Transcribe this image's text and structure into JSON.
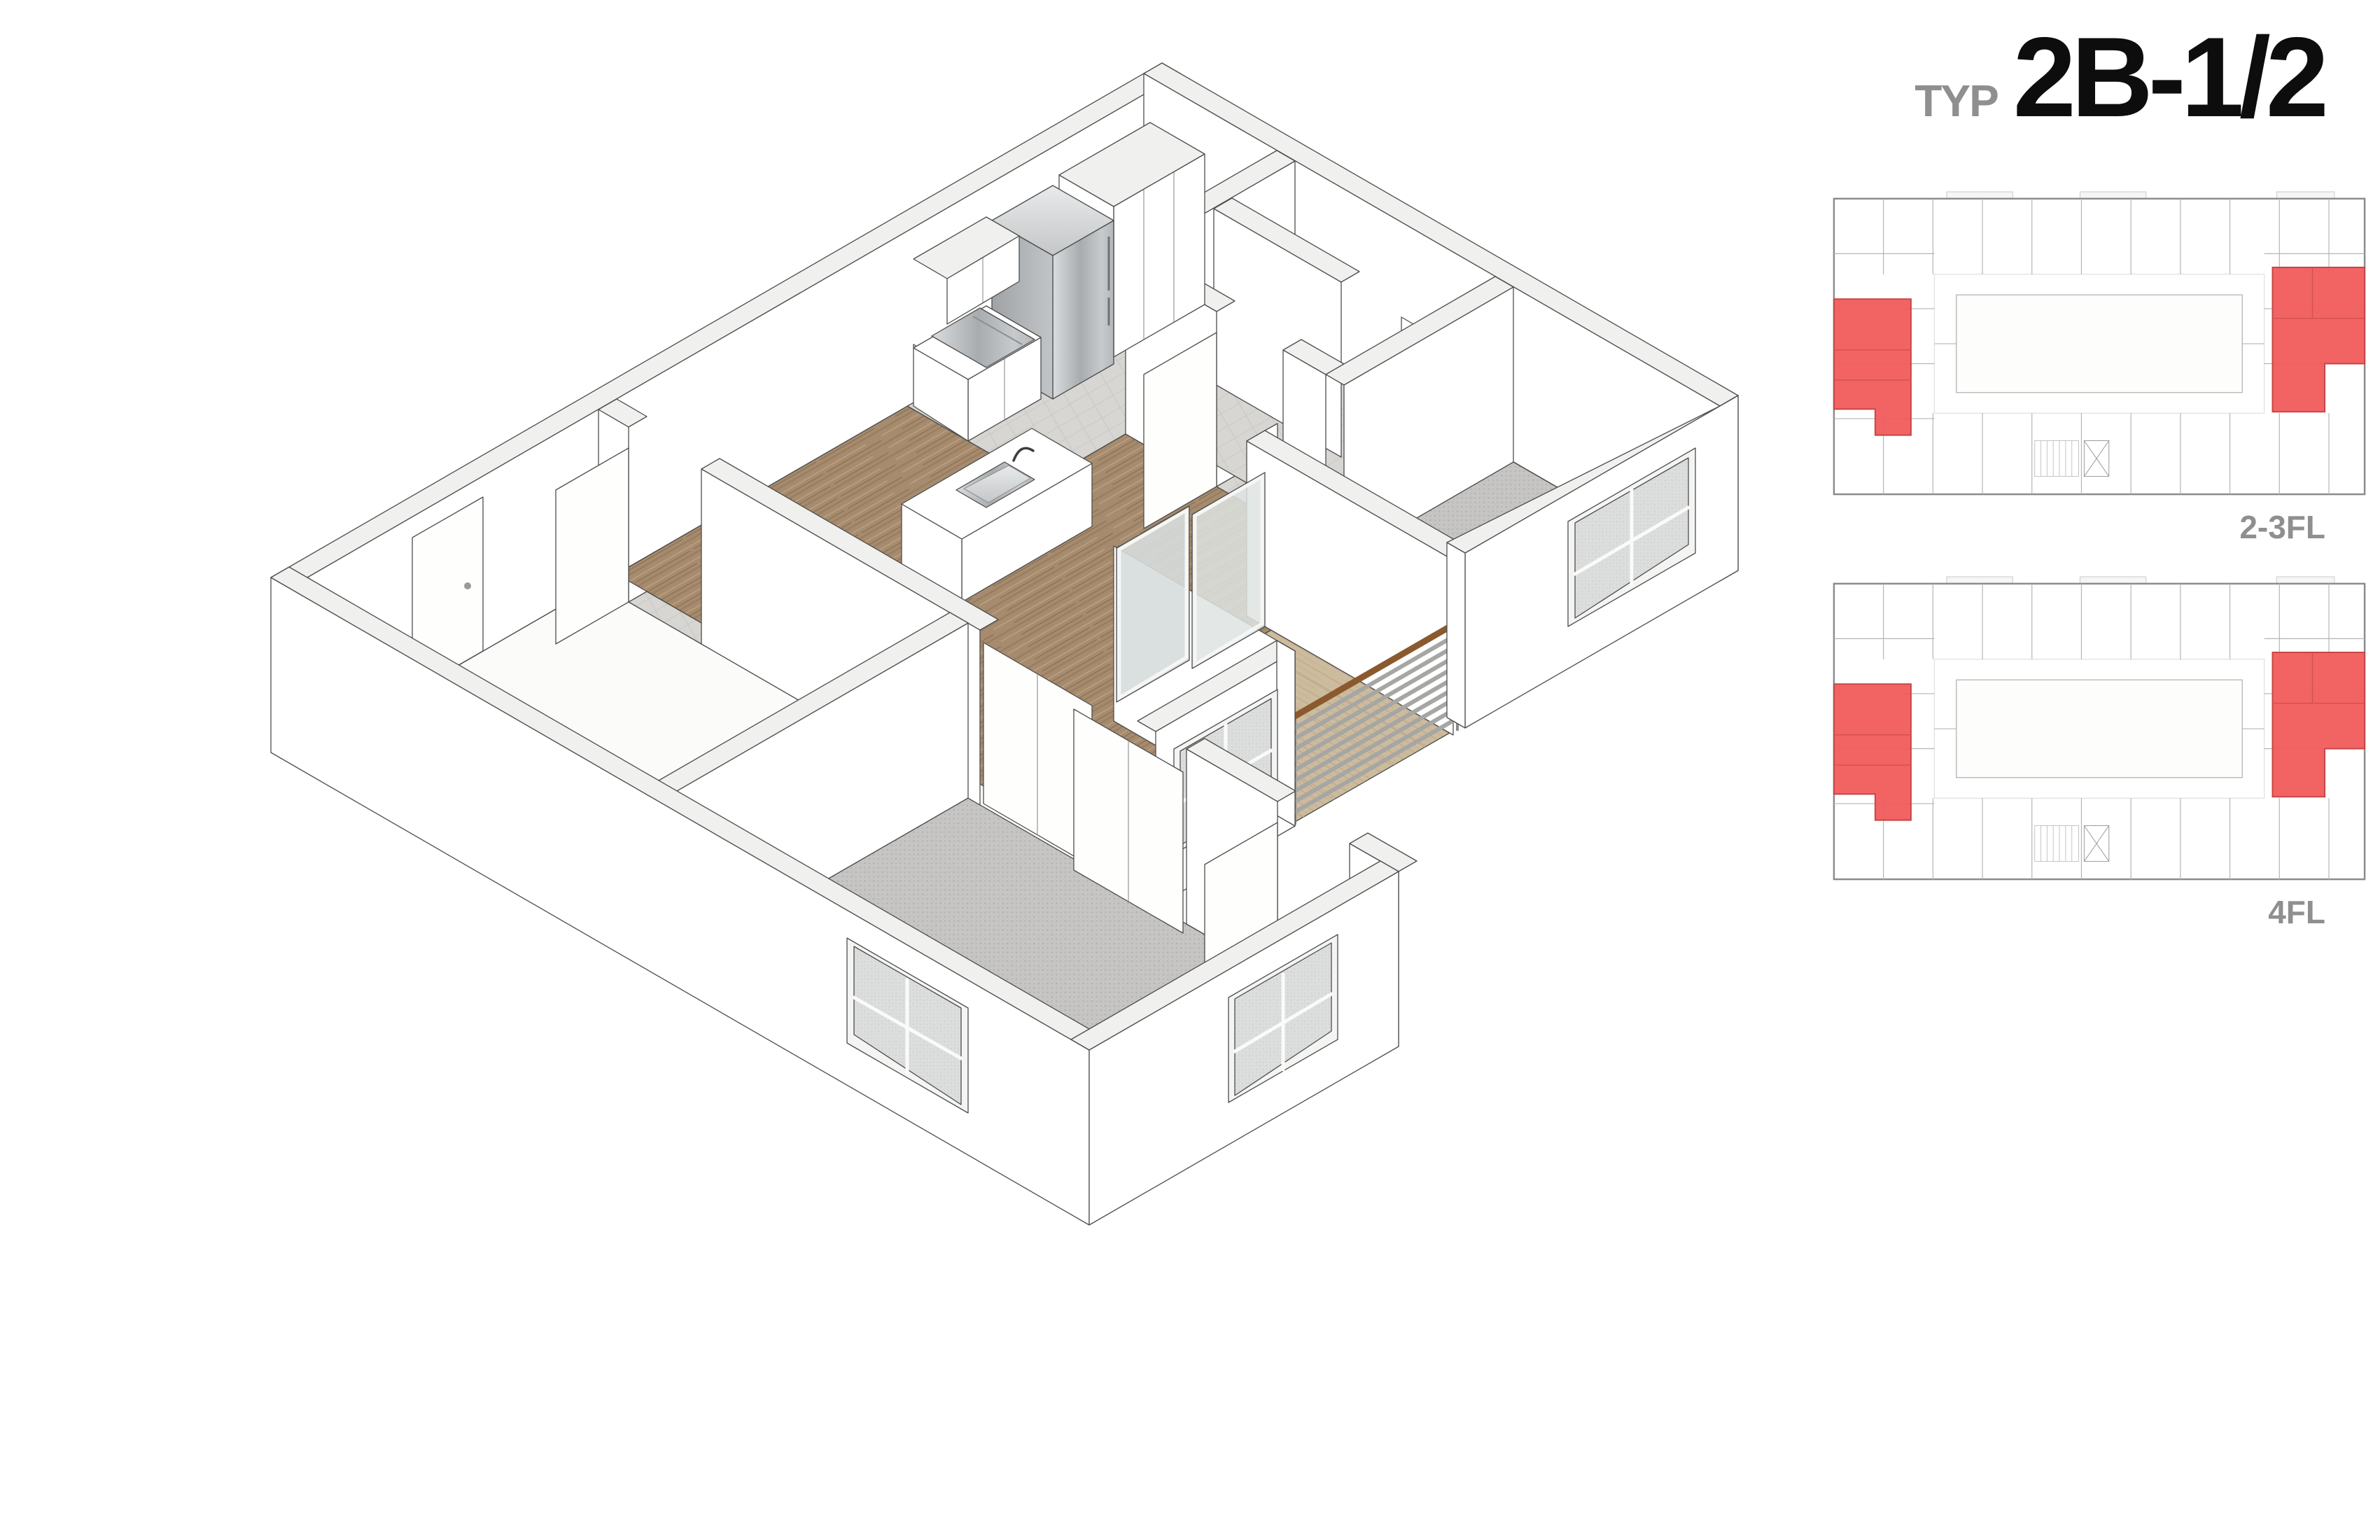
{
  "title": {
    "prefix": "TYP",
    "name": "2B-1/2"
  },
  "key_plans": [
    {
      "label": "2-3FL",
      "highlighted_units": [
        "west-wing-middle",
        "east-wing-middle"
      ]
    },
    {
      "label": "4FL",
      "highlighted_units": [
        "west-wing-middle",
        "east-wing-middle"
      ]
    }
  ],
  "axon": {
    "view": "isometric-cutaway",
    "rooms": [
      {
        "name": "Living / Dining",
        "floor": "wood"
      },
      {
        "name": "Kitchen",
        "floor": "tile",
        "appliances": [
          "refrigerator",
          "range",
          "tall-cabinets",
          "upper-cabinets",
          "island-with-sink"
        ]
      },
      {
        "name": "Bedroom 1",
        "floor": "carpet",
        "features": [
          "sliding-closet-doors",
          "window"
        ]
      },
      {
        "name": "Bedroom 2",
        "floor": "carpet",
        "features": [
          "window",
          "door"
        ]
      },
      {
        "name": "Bathroom block",
        "floor": "tile",
        "features": [
          "two-rooms",
          "door"
        ]
      },
      {
        "name": "Den / Entry",
        "floor": "bare",
        "features": [
          "entry-door"
        ]
      },
      {
        "name": "Balcony",
        "floor": "wood-deck",
        "features": [
          "slat-screen",
          "wood-handrail",
          "sliding-glass-door"
        ]
      }
    ],
    "window_count": 4
  },
  "colors": {
    "highlight-red": "#F15A5A",
    "highlight-red-stroke": "#C74545",
    "label-gray": "#8F8F8F",
    "line": "#4D4D4D",
    "wood": "#A58A6D",
    "carpet": "#C5C4C2",
    "tile": "#D8D6D2",
    "deck": "#CDBB9D",
    "steel": "#B9BCBE",
    "rail-brown": "#8A5A2E"
  }
}
